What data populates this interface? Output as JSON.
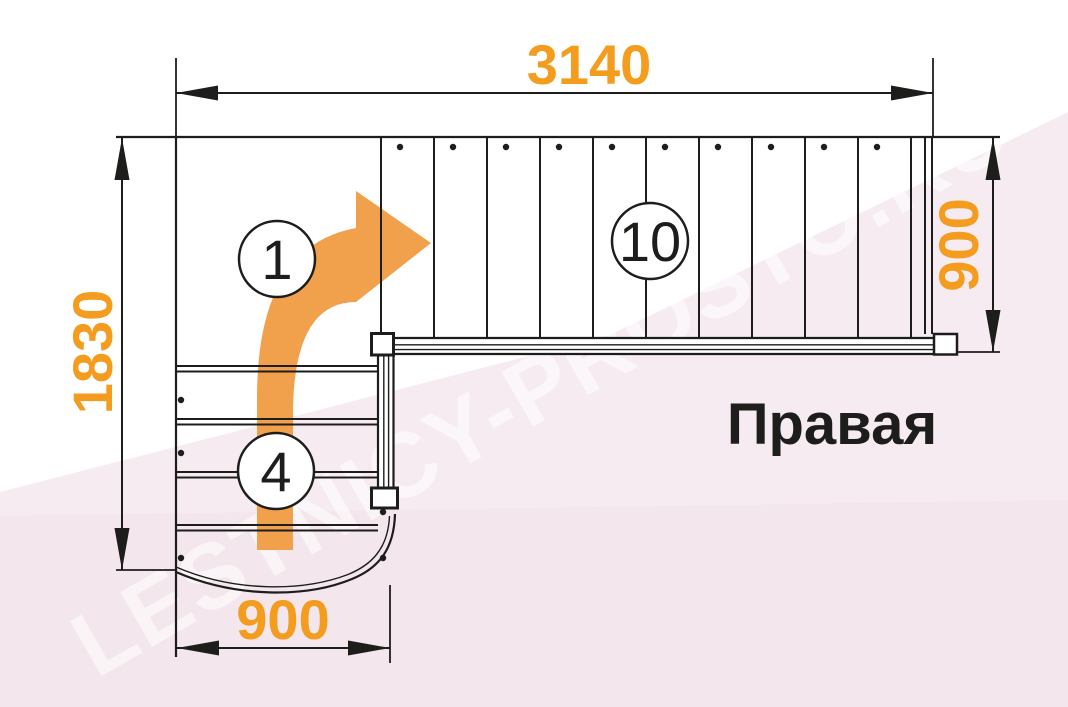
{
  "title": {
    "text": "Правая"
  },
  "watermark": {
    "text": "LESTNICY-PROSTO.RU"
  },
  "dimensions": {
    "total_length_mm": "3140",
    "total_width_mm": "1830",
    "upper_flight_width_mm": "900",
    "lower_flight_width_mm": "900"
  },
  "step_markers": {
    "first_step": "1",
    "upper_flight_steps": "10",
    "lower_flight_steps": "4"
  },
  "stairs": {
    "upper_step_count": 10,
    "lower_step_count": 4,
    "turn_direction": "right"
  },
  "colors": {
    "dimension_text": "#F39C1E",
    "arrow": "#F1A14C",
    "line": "#1D1D1B",
    "pink": "#F6EBF1",
    "pink_shade": "#EFDFE9",
    "title": "#1D1D1B",
    "watermark": "#FFFFFF"
  }
}
